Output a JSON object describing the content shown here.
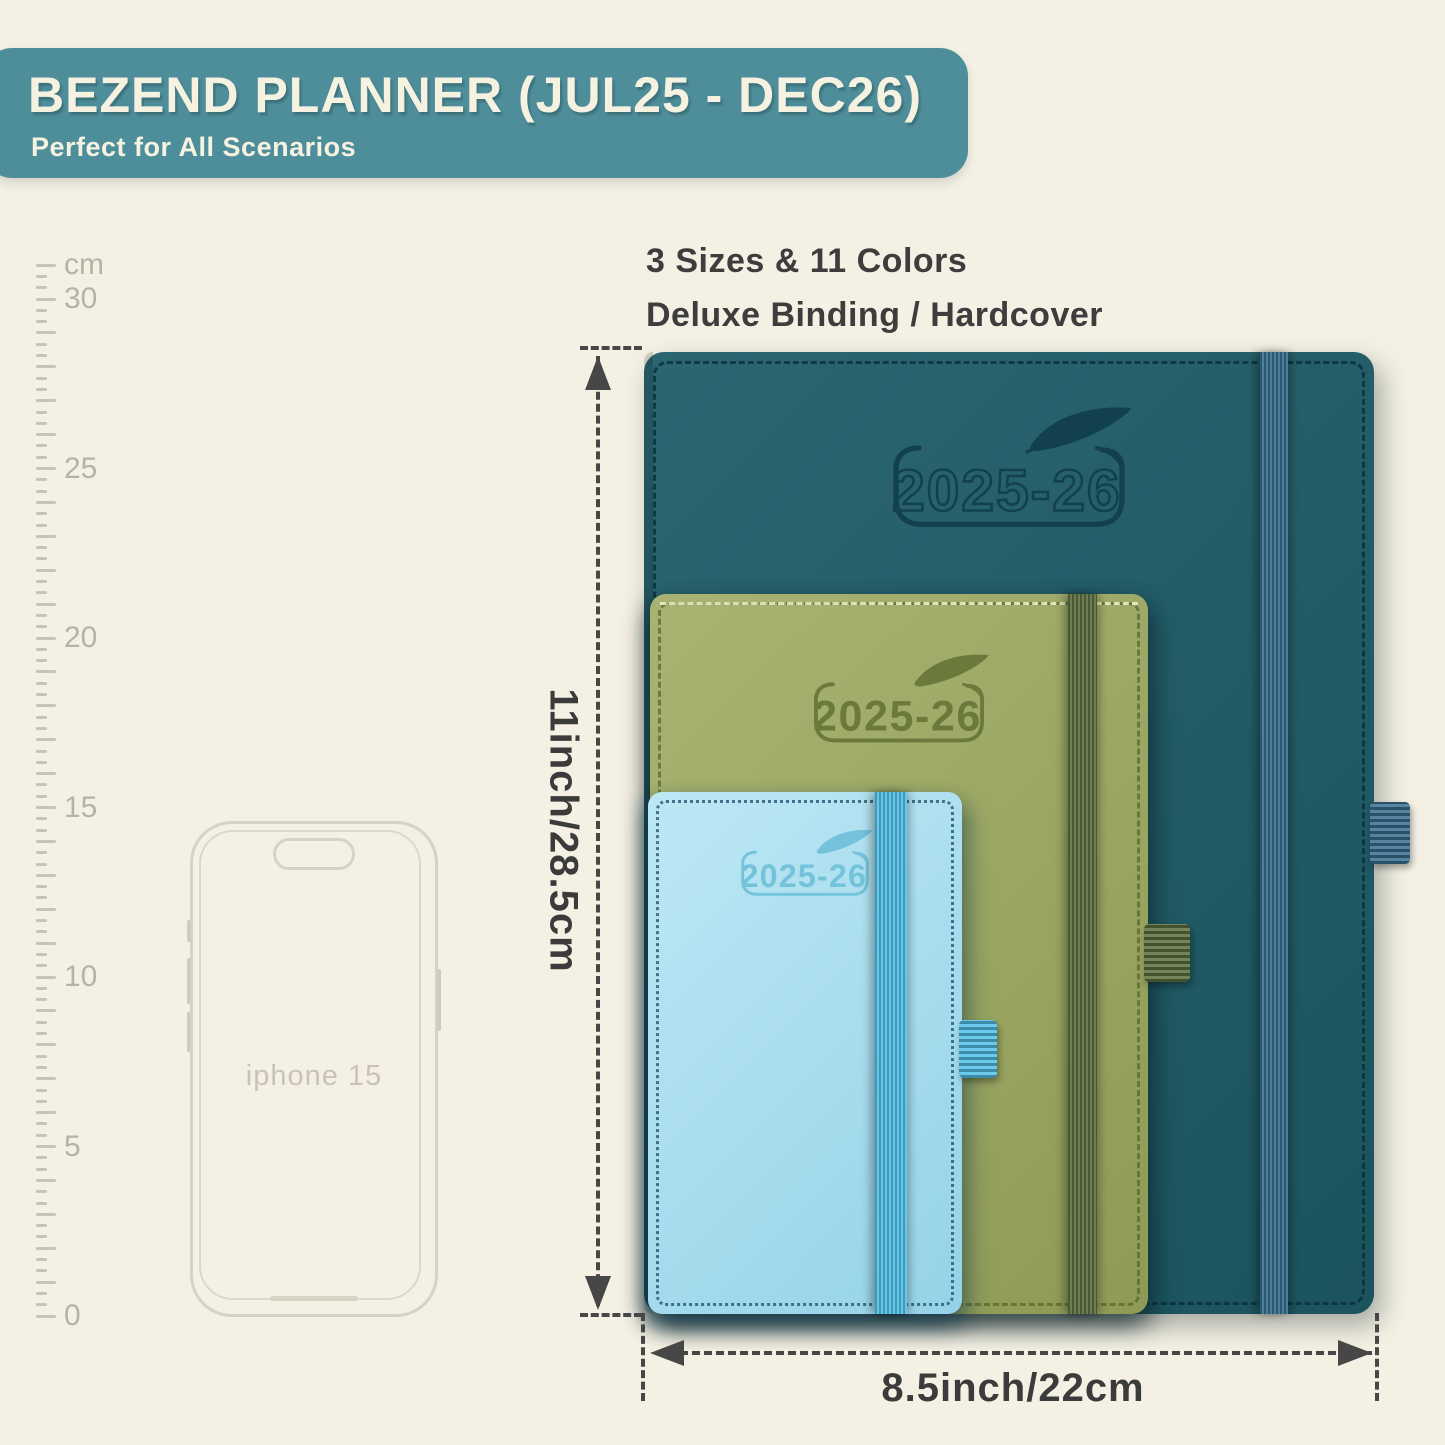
{
  "banner": {
    "title": "BEZEND PLANNER (JUL25 - DEC26)",
    "subtitle": "Perfect for All Scenarios",
    "bg": "#4e8e9a",
    "text_color": "#f6f2e2"
  },
  "features": {
    "line1": "3 Sizes & 11 Colors",
    "line2": "Deluxe Binding / Hardcover"
  },
  "ruler": {
    "unit_label": "cm",
    "max_cm": 31,
    "labeled_marks": [
      30,
      25,
      20,
      15,
      10,
      5,
      0
    ]
  },
  "phone": {
    "label": "iphone 15"
  },
  "planners": [
    {
      "size": "large",
      "year_label": "2025-26",
      "cover_color": "#1e5c68",
      "band_color": "#3a7092",
      "loop_color": "#3a7092",
      "logo_color": "#12404c"
    },
    {
      "size": "medium",
      "year_label": "2025-26",
      "cover_color": "#9fab62",
      "band_color": "#5d7040",
      "loop_color": "#5d7040",
      "logo_color": "#6b7a3c"
    },
    {
      "size": "small",
      "year_label": "2025-26",
      "cover_color": "#a6e0f2",
      "band_color": "#53c2ea",
      "loop_color": "#53c2ea",
      "logo_color": "#74c3db"
    }
  ],
  "dimensions": {
    "height_label": "11inch/28.5cm",
    "width_label": "8.5inch/22cm",
    "line_color": "#474747"
  }
}
